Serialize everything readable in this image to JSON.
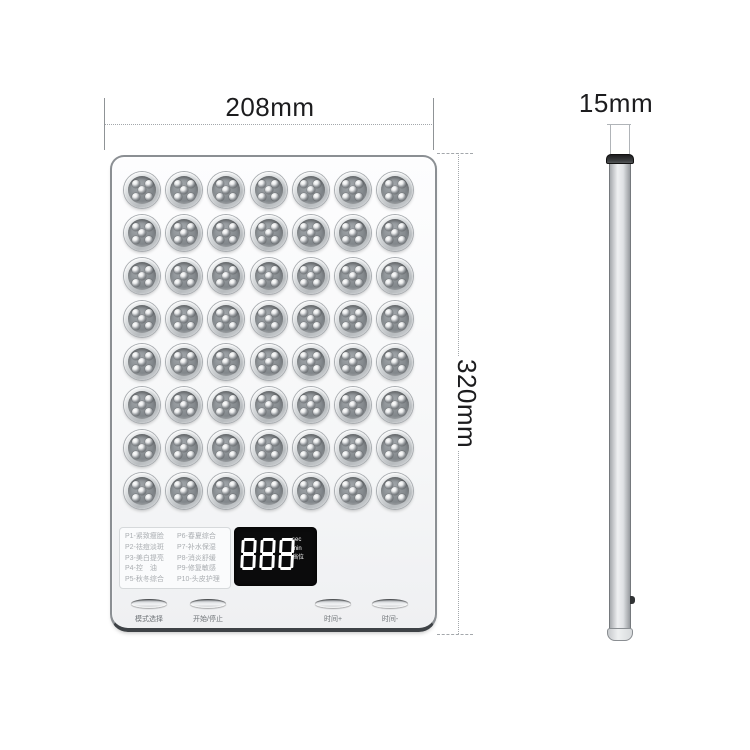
{
  "front_view": {
    "width_label": "208mm",
    "height_label": "320mm",
    "led_grid": {
      "rows": 8,
      "cols": 7,
      "dots_per_module": 5
    },
    "mode_list": {
      "column1": [
        "P1-紧致瘦脸",
        "P2-祛痘淡斑",
        "P3-美白提亮",
        "P4-控　油",
        "P5-秋冬综合"
      ],
      "column2": [
        "P6-春夏综合",
        "P7-补水保湿",
        "P8-消炎舒缓",
        "P9-修复敏感",
        "P10-头皮护理"
      ]
    },
    "display": {
      "value": "888",
      "unit_labels": [
        "sec",
        "min",
        "档位"
      ]
    },
    "buttons": [
      {
        "label": "模式选择"
      },
      {
        "label": "开始/停止"
      },
      {
        "label": "时间+"
      },
      {
        "label": "时间-"
      }
    ]
  },
  "side_view": {
    "thickness_label": "15mm"
  },
  "colors": {
    "display_background": "#0b0b0c",
    "digit_color": "#ffffff",
    "dimension_text": "#1c1c1e",
    "panel_edge_dark": "#3e4246"
  }
}
